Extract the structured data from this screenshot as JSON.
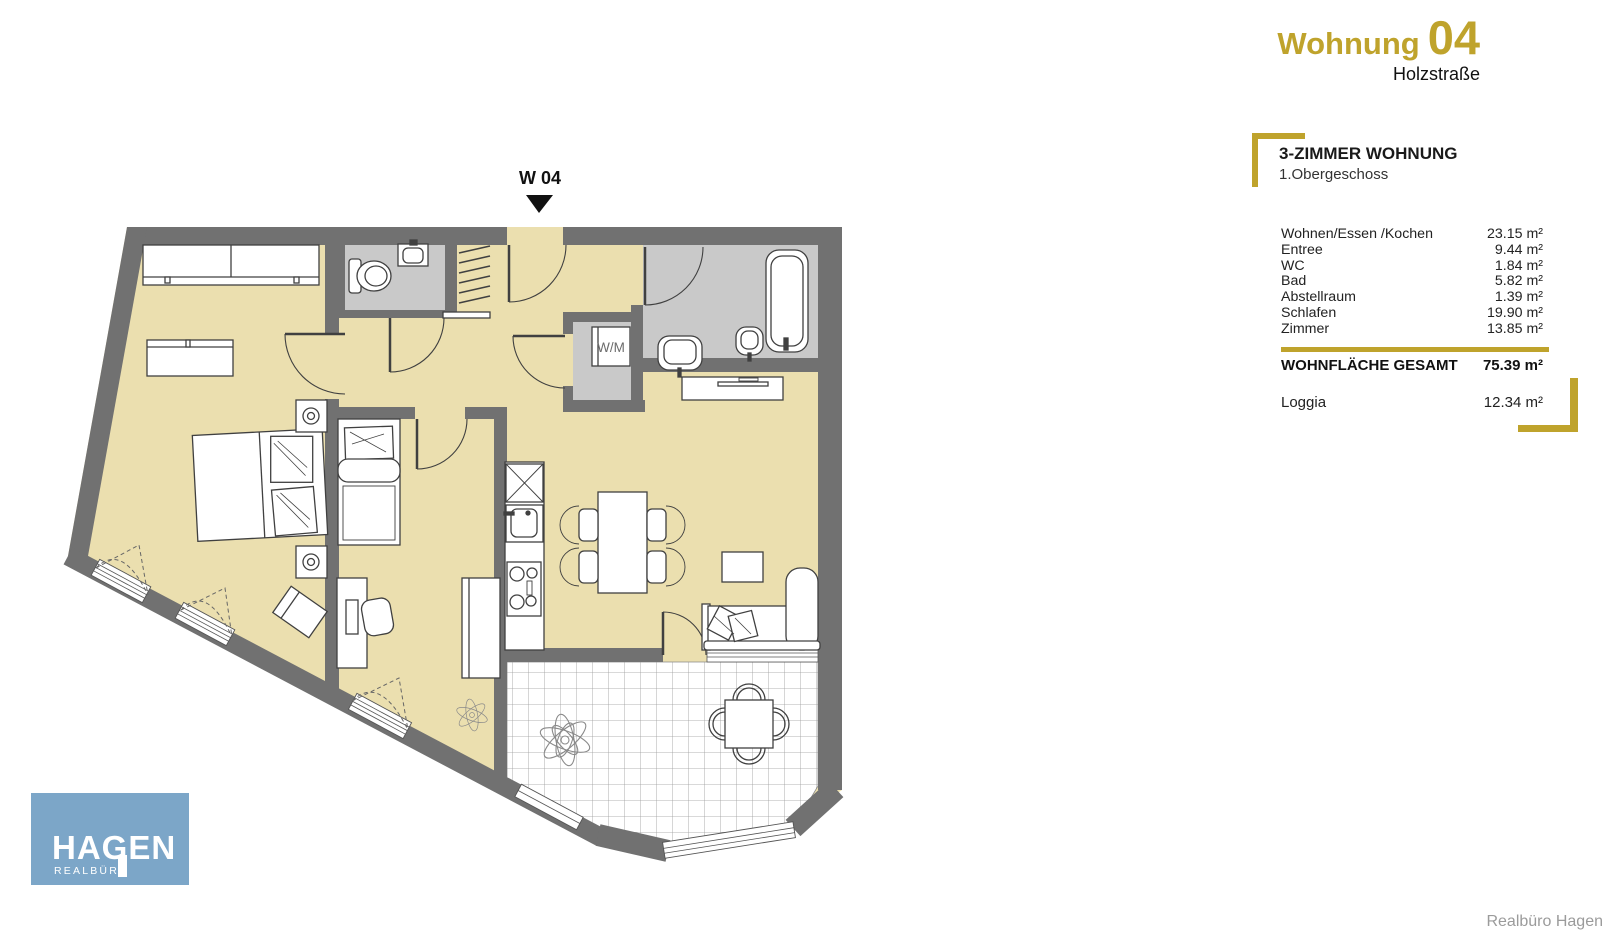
{
  "header": {
    "title_word": "Wohnung",
    "title_number": "04",
    "subtitle": "Holzstraße"
  },
  "details": {
    "type_title": "3-ZIMMER WOHNUNG",
    "floor": "1.Obergeschoss",
    "rooms": [
      {
        "label": "Wohnen/Essen /Kochen",
        "area": "23.15 m²"
      },
      {
        "label": "Entree",
        "area": "9.44 m²"
      },
      {
        "label": "WC",
        "area": "1.84 m²"
      },
      {
        "label": "Bad",
        "area": "5.82 m²"
      },
      {
        "label": "Abstellraum",
        "area": "1.39 m²"
      },
      {
        "label": "Schlafen",
        "area": "19.90 m²"
      },
      {
        "label": "Zimmer",
        "area": "13.85 m²"
      }
    ],
    "total": {
      "label": "WOHNFLÄCHE GESAMT",
      "area": "75.39 m²"
    },
    "loggia": {
      "label": "Loggia",
      "area": "12.34 m²"
    }
  },
  "plan": {
    "marker_label": "W 04",
    "washing_machine_label": "W/M"
  },
  "logo": {
    "brand": "HAGEN",
    "division": "REALBÜRO"
  },
  "footer": {
    "credit": "Realbüro Hagen"
  },
  "colors": {
    "accent_gold": "#bfa32c",
    "floor_beige": "#ebdfaf",
    "wall_gray": "#717171",
    "wet_room_gray": "#c9c9c9",
    "logo_blue": "#7ca6c8"
  }
}
